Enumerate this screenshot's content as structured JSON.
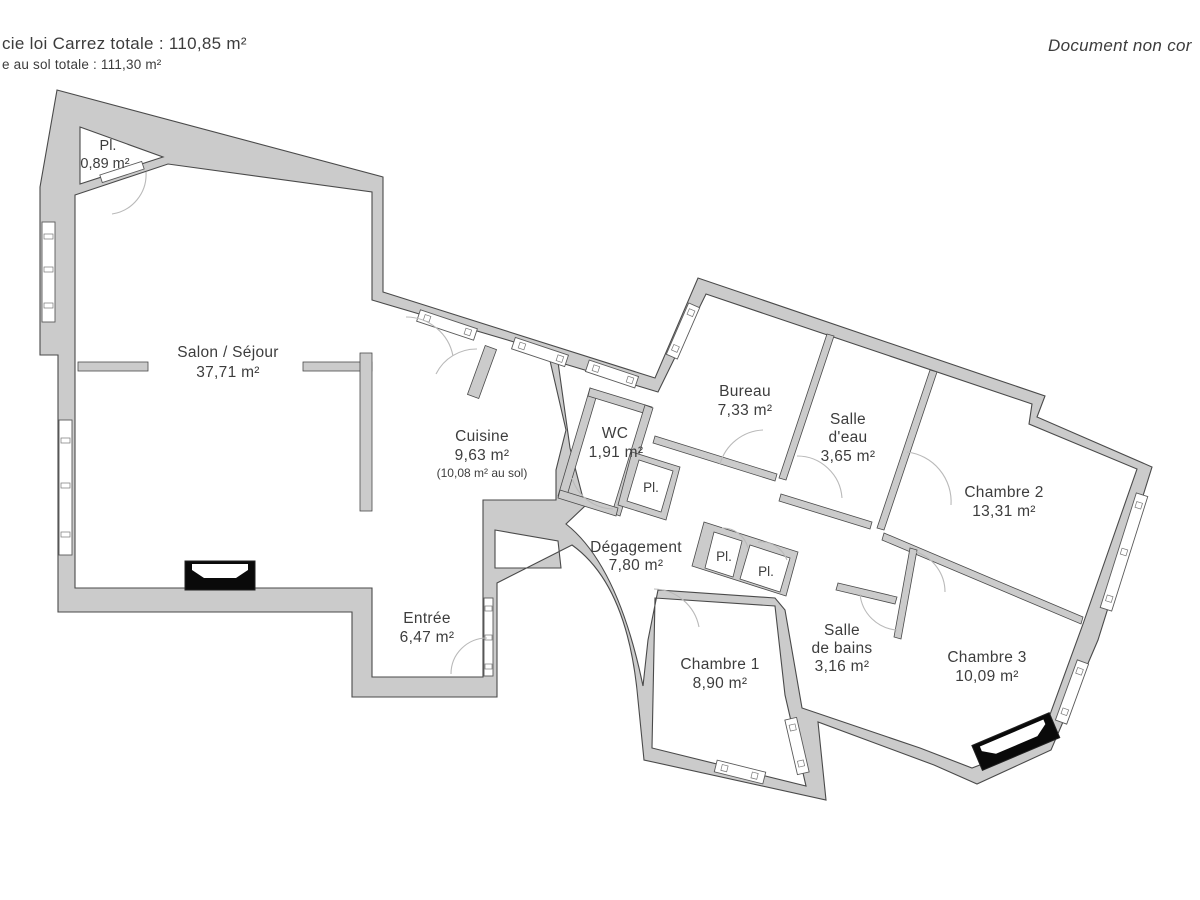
{
  "header": {
    "left_line1": "cie loi Carrez totale :  110,85 m²",
    "left_line2": "e au sol totale :  111,30 m²",
    "right_note": "Document non cor"
  },
  "rooms": {
    "pl_triangle": {
      "label": "Pl.",
      "area": "0,89 m²"
    },
    "salon": {
      "label": "Salon / Séjour",
      "area": "37,71 m²"
    },
    "cuisine": {
      "label": "Cuisine",
      "area": "9,63 m²",
      "area_floor": "(10,08 m² au sol)"
    },
    "wc": {
      "label": "WC",
      "area": "1,91 m²"
    },
    "placard_wc": {
      "label": "Pl."
    },
    "bureau": {
      "label": "Bureau",
      "area": "7,33 m²"
    },
    "salle_deau": {
      "label_line1": "Salle",
      "label_line2": "d'eau",
      "area": "3,65 m²"
    },
    "chambre2": {
      "label": "Chambre 2",
      "area": "13,31 m²"
    },
    "degagement": {
      "label": "Dégagement",
      "area": "7,80 m²"
    },
    "placard1": {
      "label": "Pl."
    },
    "placard2": {
      "label": "Pl."
    },
    "entree": {
      "label": "Entrée",
      "area": "6,47 m²"
    },
    "chambre1": {
      "label": "Chambre 1",
      "area": "8,90 m²"
    },
    "salle_bains": {
      "label_line1": "Salle",
      "label_line2": "de bains",
      "area": "3,16 m²"
    },
    "chambre3": {
      "label": "Chambre 3",
      "area": "10,09 m²"
    }
  },
  "colors": {
    "wall_fill": "#cbcbcb",
    "wall_stroke": "#4a4a4a",
    "door_arc": "#b9b9b9",
    "text": "#3d3d3d"
  }
}
